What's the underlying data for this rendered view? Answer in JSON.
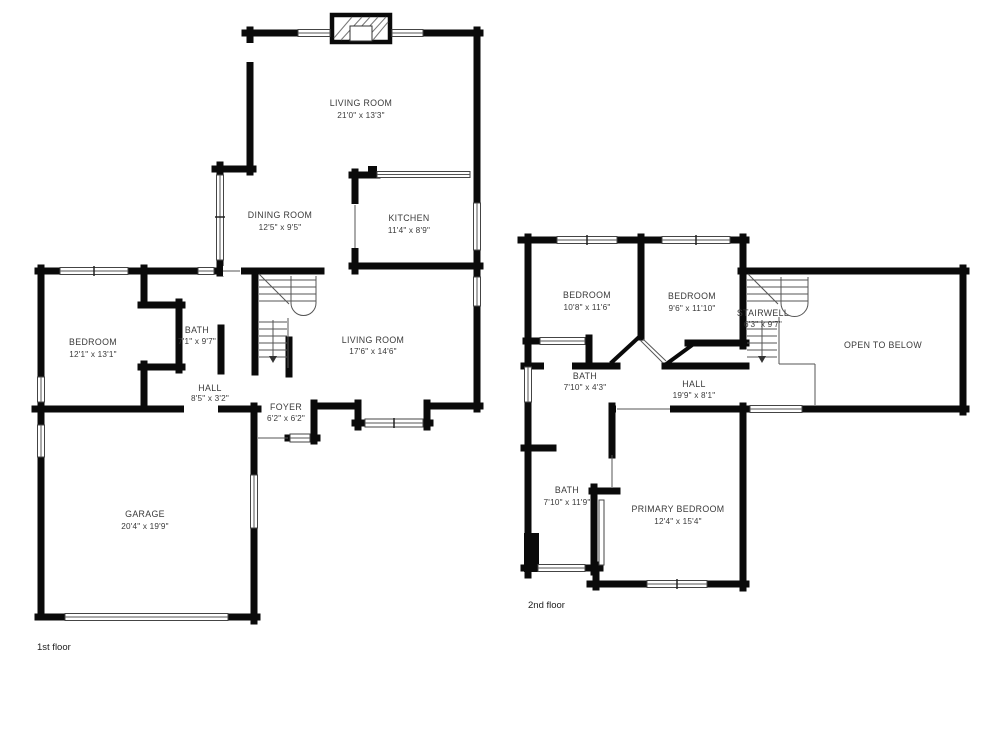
{
  "colors": {
    "wall": "#0a0a0a",
    "thin_line": "#555555",
    "text": "#3a3a3a",
    "background": "#ffffff"
  },
  "floors": [
    {
      "label": "1st floor",
      "rooms": [
        {
          "name": "LIVING ROOM",
          "dims": "21'0\" x 13'3\""
        },
        {
          "name": "DINING ROOM",
          "dims": "12'5\" x 9'5\""
        },
        {
          "name": "KITCHEN",
          "dims": "11'4\" x 8'9\""
        },
        {
          "name": "BEDROOM",
          "dims": "12'1\" x 13'1\""
        },
        {
          "name": "BATH",
          "dims": "7'1\" x 9'7\""
        },
        {
          "name": "HALL",
          "dims": "8'5\" x 3'2\""
        },
        {
          "name": "FOYER",
          "dims": "6'2\" x 6'2\""
        },
        {
          "name": "LIVING ROOM",
          "dims": "17'6\" x 14'6\""
        },
        {
          "name": "GARAGE",
          "dims": "20'4\" x 19'9\""
        }
      ]
    },
    {
      "label": "2nd floor",
      "rooms": [
        {
          "name": "BEDROOM",
          "dims": "10'8\" x 11'6\""
        },
        {
          "name": "BEDROOM",
          "dims": "9'6\" x 11'10\""
        },
        {
          "name": "STAIRWELL",
          "dims": "6'3\" x 9'7\""
        },
        {
          "name": "OPEN TO BELOW",
          "dims": ""
        },
        {
          "name": "BATH",
          "dims": "7'10\" x 4'3\""
        },
        {
          "name": "HALL",
          "dims": "19'9\" x 8'1\""
        },
        {
          "name": "BATH",
          "dims": "7'10\" x 11'9\""
        },
        {
          "name": "PRIMARY BEDROOM",
          "dims": "12'4\" x 15'4\""
        }
      ]
    }
  ]
}
